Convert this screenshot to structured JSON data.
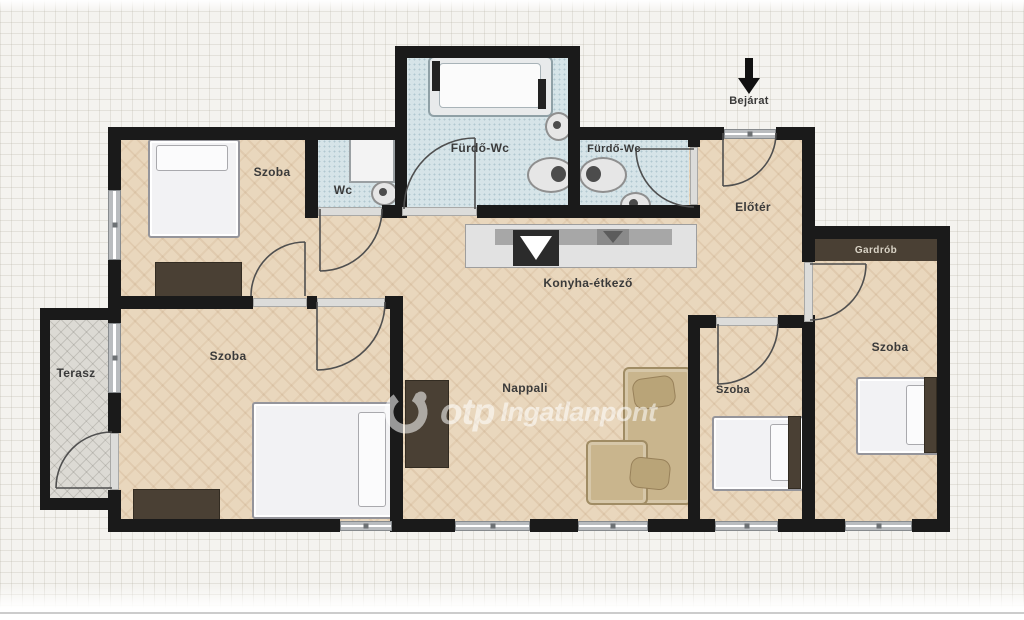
{
  "watermark": {
    "brand": "otp",
    "suffix": "Ingatlanpont"
  },
  "entrance": {
    "label": "Bejárat"
  },
  "rooms": {
    "szoba_top_left": "Szoba",
    "wc": "Wc",
    "furdo_main": "Fürdő-Wc",
    "furdo_small": "Fürdő-Wc",
    "eloter": "Előtér",
    "gardrob": "Gardrób",
    "szoba_right": "Szoba",
    "szoba_middle": "Szoba",
    "nappali": "Nappali",
    "konyha": "Konyha-étkező",
    "szoba_bottom_left": "Szoba",
    "terasz": "Terasz"
  },
  "colors": {
    "wall": "#1a1a1a",
    "wood_floor": "#e9d7bd",
    "bathroom_tile": "#d6e4e8",
    "terrace_tile": "#dcdad4",
    "dark_furniture": "#4a4034",
    "couch": "#c9b58d",
    "watermark": "#ffffff"
  }
}
